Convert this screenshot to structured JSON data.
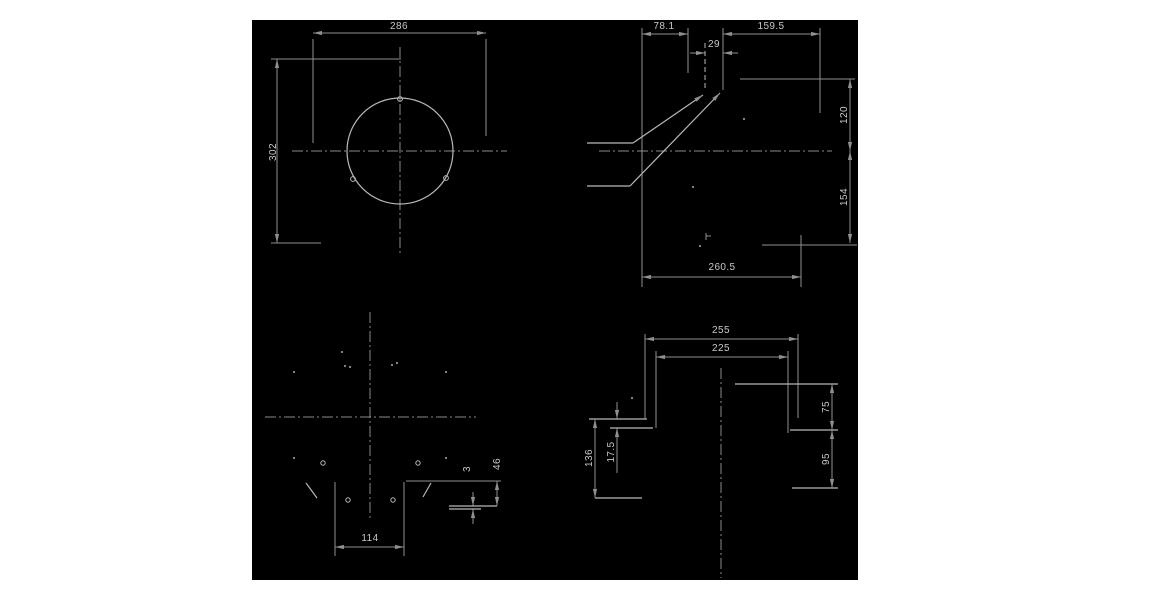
{
  "drawing": {
    "canvas": {
      "x": 252,
      "y": 20,
      "w": 606,
      "h": 560
    },
    "colors": {
      "page_background": "#ffffff",
      "background": "#000000",
      "edge": "#b8b8b8",
      "dim": "#8f8f8f",
      "centerline": "#8a8a8a",
      "text": "#c8c8c8"
    },
    "views": {
      "front_view": {
        "centerlines": [
          [
            400,
            47,
            400,
            254
          ],
          [
            292,
            151,
            507,
            151
          ]
        ],
        "circles": [
          [
            400,
            151,
            53
          ],
          [
            400,
            99,
            2.4
          ],
          [
            353,
            179,
            2.4
          ],
          [
            446,
            178,
            2.4
          ]
        ],
        "ext_lines": [
          [
            313,
            39,
            313,
            143
          ],
          [
            486,
            39,
            486,
            136
          ],
          [
            271,
            59,
            401,
            59
          ],
          [
            271,
            243,
            321,
            243
          ]
        ],
        "dims": [
          {
            "label": "286",
            "line": [
              313,
              33,
              486,
              33
            ],
            "arrows": [
              [
                313,
                33,
                180
              ],
              [
                486,
                33,
                0
              ]
            ],
            "text": [
              399,
              29
            ],
            "rot": 0
          },
          {
            "label": "302",
            "line": [
              277,
              59,
              277,
              243
            ],
            "arrows": [
              [
                277,
                59,
                -90
              ],
              [
                277,
                243,
                90
              ]
            ],
            "text": [
              276,
              152
            ],
            "rot": -90
          }
        ]
      },
      "side_view": {
        "centerlines": [
          [
            599,
            151,
            832,
            151
          ]
        ],
        "edges": [
          [
            587,
            143,
            633,
            143
          ],
          [
            633,
            143,
            703,
            95
          ],
          [
            587,
            186,
            630,
            186
          ],
          [
            630,
            186,
            720,
            93
          ]
        ],
        "dashed_edges": [
          [
            705,
            43,
            705,
            90
          ]
        ],
        "arrows": [
          [
            703,
            95,
            -34
          ],
          [
            720,
            93,
            -46
          ]
        ],
        "ext_lines": [
          [
            723,
            28,
            723,
            90
          ],
          [
            642,
            28,
            642,
            287
          ],
          [
            688,
            28,
            688,
            73
          ],
          [
            820,
            28,
            820,
            113
          ],
          [
            740,
            79,
            855,
            79
          ],
          [
            762,
            245,
            857,
            245
          ],
          [
            801,
            235,
            801,
            287
          ],
          [
            690,
            53,
            705,
            53
          ],
          [
            723,
            53,
            738,
            53
          ],
          [
            706,
            233,
            706,
            240
          ],
          [
            706,
            236,
            711,
            236
          ]
        ],
        "dots": [
          [
            693,
            187
          ],
          [
            744,
            119
          ],
          [
            700,
            246
          ]
        ],
        "dims": [
          {
            "label": "78.1",
            "line": [
              642,
              34,
              688,
              34
            ],
            "arrows": [
              [
                642,
                34,
                180
              ],
              [
                688,
                34,
                0
              ]
            ],
            "text": [
              664,
              29
            ],
            "rot": 0
          },
          {
            "label": "29",
            "line": null,
            "arrows": [
              [
                705,
                53,
                0
              ],
              [
                723,
                53,
                180
              ]
            ],
            "text": [
              714,
              47
            ],
            "rot": 0
          },
          {
            "label": "159.5",
            "line": [
              723,
              34,
              820,
              34
            ],
            "arrows": [
              [
                723,
                34,
                180
              ],
              [
                820,
                34,
                0
              ]
            ],
            "text": [
              771,
              29
            ],
            "rot": 0
          },
          {
            "label": "120",
            "line": [
              850,
              79,
              850,
              151
            ],
            "arrows": [
              [
                850,
                79,
                -90
              ],
              [
                850,
                151,
                90
              ]
            ],
            "text": [
              847,
              115
            ],
            "rot": -90
          },
          {
            "label": "154",
            "line": [
              850,
              151,
              850,
              243
            ],
            "arrows": [
              [
                850,
                151,
                -90
              ],
              [
                850,
                243,
                90
              ]
            ],
            "text": [
              847,
              197
            ],
            "rot": -90
          },
          {
            "label": "260.5",
            "line": [
              642,
              277,
              801,
              277
            ],
            "arrows": [
              [
                642,
                277,
                180
              ],
              [
                801,
                277,
                0
              ]
            ],
            "text": [
              722,
              270
            ],
            "rot": 0
          }
        ]
      },
      "bottom_view": {
        "centerlines": [
          [
            370,
            312,
            370,
            519
          ],
          [
            265,
            417,
            476,
            417
          ]
        ],
        "circles": [
          [
            323,
            463,
            2.2
          ],
          [
            418,
            463,
            2.2
          ],
          [
            348,
            500,
            2.2
          ],
          [
            393,
            500,
            2.2
          ]
        ],
        "edges": [
          [
            306,
            483,
            317,
            498
          ],
          [
            431,
            483,
            423,
            497
          ],
          [
            449,
            506,
            497,
            506
          ],
          [
            449,
            509,
            481,
            509
          ]
        ],
        "ext_lines": [
          [
            335,
            482,
            335,
            556
          ],
          [
            404,
            482,
            404,
            556
          ],
          [
            406,
            481,
            501,
            481
          ],
          [
            473,
            492,
            473,
            506
          ],
          [
            473,
            509,
            473,
            524
          ]
        ],
        "dots": [
          [
            294,
            372
          ],
          [
            446,
            372
          ],
          [
            294,
            458
          ],
          [
            446,
            458
          ],
          [
            342,
            352
          ],
          [
            345,
            366
          ],
          [
            350,
            367
          ],
          [
            392,
            365
          ],
          [
            397,
            363
          ]
        ],
        "dims": [
          {
            "label": "114",
            "line": [
              335,
              547,
              404,
              547
            ],
            "arrows": [
              [
                335,
                547,
                180
              ],
              [
                404,
                547,
                0
              ]
            ],
            "text": [
              370,
              541
            ],
            "rot": 0
          },
          {
            "label": "46",
            "line": [
              497,
              481,
              497,
              506
            ],
            "arrows": [
              [
                497,
                481,
                -90
              ],
              [
                497,
                506,
                90
              ]
            ],
            "text": [
              500,
              464
            ],
            "rot": -90
          },
          {
            "label": "3",
            "line": null,
            "arrows": [
              [
                473,
                506,
                90
              ],
              [
                473,
                509,
                -90
              ]
            ],
            "text": [
              470,
              469
            ],
            "rot": -90
          }
        ]
      },
      "section_view": {
        "centerlines": [
          [
            721,
            368,
            721,
            578
          ]
        ],
        "edges": [
          [
            589,
            419,
            647,
            419
          ],
          [
            610,
            428,
            653,
            428
          ],
          [
            595,
            498,
            642,
            498
          ],
          [
            735,
            384,
            838,
            384
          ],
          [
            790,
            430,
            838,
            430
          ],
          [
            792,
            488,
            838,
            488
          ]
        ],
        "ext_lines": [
          [
            645,
            334,
            645,
            419
          ],
          [
            656,
            351,
            656,
            428
          ],
          [
            798,
            334,
            798,
            418
          ],
          [
            788,
            351,
            788,
            433
          ],
          [
            617,
            402,
            617,
            419
          ],
          [
            617,
            428,
            617,
            473
          ]
        ],
        "dots": [
          [
            632,
            398
          ]
        ],
        "dims": [
          {
            "label": "255",
            "line": [
              645,
              339,
              798,
              339
            ],
            "arrows": [
              [
                645,
                339,
                180
              ],
              [
                798,
                339,
                0
              ]
            ],
            "text": [
              721,
              333
            ],
            "rot": 0
          },
          {
            "label": "225",
            "line": [
              656,
              357,
              788,
              357
            ],
            "arrows": [
              [
                656,
                357,
                180
              ],
              [
                788,
                357,
                0
              ]
            ],
            "text": [
              721,
              351
            ],
            "rot": 0
          },
          {
            "label": "75",
            "line": [
              832,
              384,
              832,
              430
            ],
            "arrows": [
              [
                832,
                384,
                -90
              ],
              [
                832,
                430,
                90
              ]
            ],
            "text": [
              829,
              407
            ],
            "rot": -90
          },
          {
            "label": "95",
            "line": [
              832,
              430,
              832,
              488
            ],
            "arrows": [
              [
                832,
                430,
                -90
              ],
              [
                832,
                488,
                90
              ]
            ],
            "text": [
              829,
              459
            ],
            "rot": -90
          },
          {
            "label": "136",
            "line": [
              595,
              419,
              595,
              498
            ],
            "arrows": [
              [
                595,
                419,
                -90
              ],
              [
                595,
                498,
                90
              ]
            ],
            "text": [
              592,
              458
            ],
            "rot": -90
          },
          {
            "label": "17.5",
            "line": null,
            "arrows": [
              [
                617,
                419,
                90
              ],
              [
                617,
                428,
                -90
              ]
            ],
            "text": [
              614,
              452
            ],
            "rot": -90
          }
        ]
      }
    }
  }
}
